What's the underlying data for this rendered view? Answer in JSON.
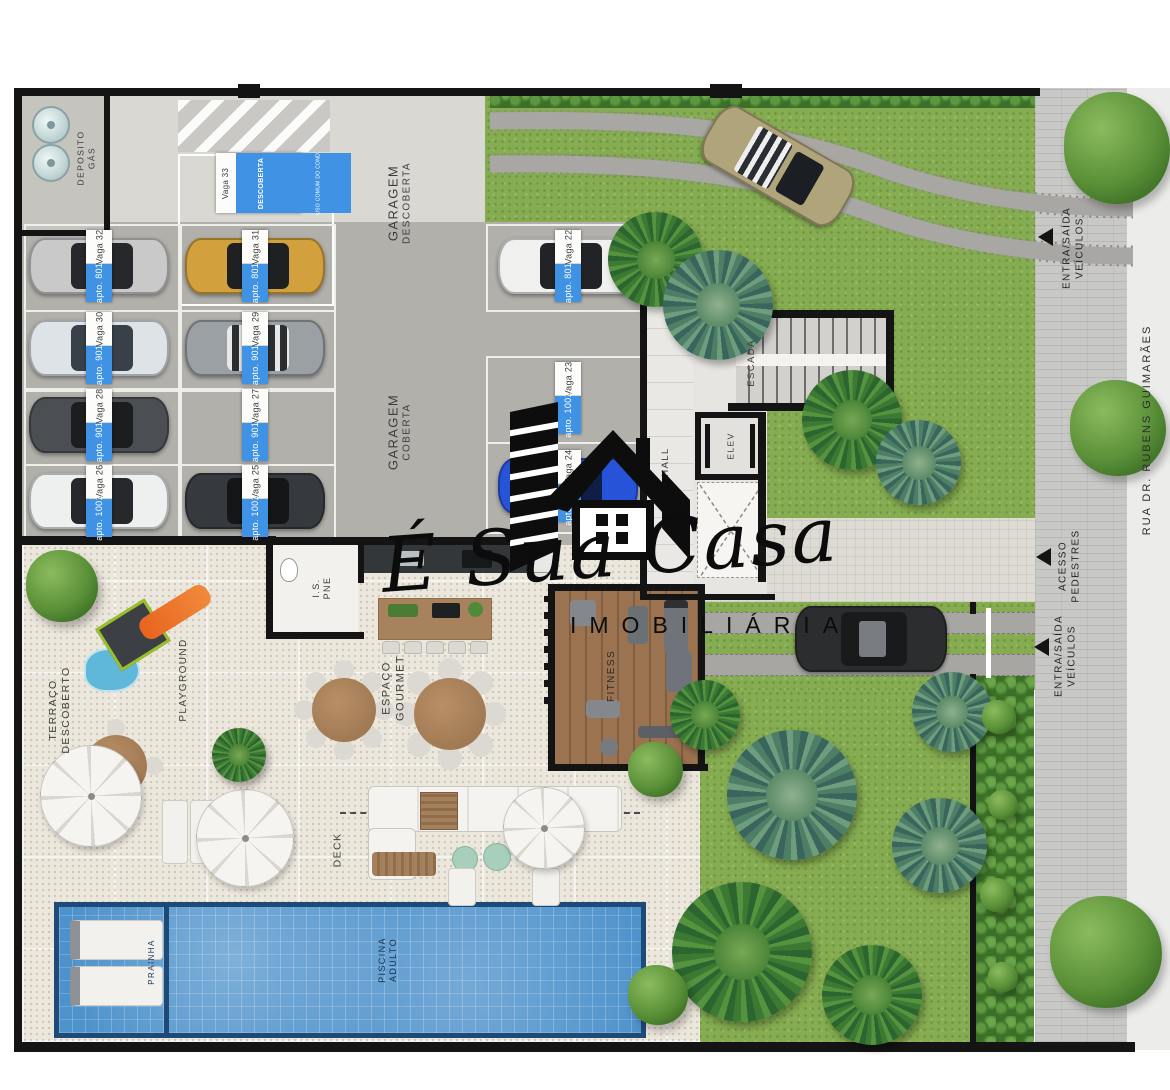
{
  "palette": {
    "tag_blue": "#3f92e4",
    "grass_green": "#85ac51",
    "pool_blue": "#4e92cb",
    "garage_covered_gray": "#b2b0ab",
    "garage_uncovered_gray": "#d9d8d3",
    "wall_black": "#141414",
    "paving_beige": "#ece7dd"
  },
  "logo": {
    "title": "É Sua Casa",
    "subtitle": "IMOBILIÁRIA"
  },
  "street": {
    "name": "RUA DR. RUBENS GUIMARÃES",
    "vehicle_entrance_top": {
      "line1": "ENTRA/SAÍDA",
      "line2": "VEÍCULOS"
    },
    "pedestrian_access": {
      "line1": "ACESSO",
      "line2": "PEDESTRES"
    },
    "vehicle_entrance_bottom": {
      "line1": "ENTRA/SAÍDA",
      "line2": "VEÍCULOS"
    }
  },
  "garage": {
    "uncovered": {
      "line1": "GARAGEM",
      "line2": "DESCOBERTA"
    },
    "covered": {
      "line1": "GARAGEM",
      "line2": "COBERTA"
    },
    "gas_room": {
      "line1": "DEPOSITO",
      "line2": "GÁS"
    }
  },
  "building": {
    "hall": "HALL",
    "stairs": "ESCADA",
    "elevator": "ELEV"
  },
  "leisure": {
    "terrace": {
      "line1": "TERRAÇO",
      "line2": "DESCOBERTO"
    },
    "playground": "PLAYGROUND",
    "gourmet": {
      "line1": "ESPAÇO",
      "line2": "GOURMET"
    },
    "fitness": "FITNESS",
    "deck": "DECK",
    "accessible_wc": {
      "line1": "I.S.",
      "line2": "PNE"
    },
    "pool_kids": "PRAINHA",
    "pool_adult": {
      "line1": "PISCINA",
      "line2": "ADULTO"
    }
  },
  "parking": {
    "spot33": {
      "vaga": "Vaga 33",
      "big": "DESCOBERTA",
      "small": "USO COMUM DO COND."
    },
    "spots": [
      {
        "vaga": "Vaga 32",
        "apto": "apto. 801"
      },
      {
        "vaga": "Vaga 31",
        "apto": "apto. 801"
      },
      {
        "vaga": "Vaga 30",
        "apto": "apto. 901"
      },
      {
        "vaga": "Vaga 29",
        "apto": "apto. 901"
      },
      {
        "vaga": "Vaga 28",
        "apto": "apto. 901"
      },
      {
        "vaga": "Vaga 27",
        "apto": "apto. 901"
      },
      {
        "vaga": "Vaga 26",
        "apto": "apto. 1001"
      },
      {
        "vaga": "Vaga 25",
        "apto": "apto. 1001"
      },
      {
        "vaga": "Vaga 22",
        "apto": "apto. 801"
      },
      {
        "vaga": "Vaga 23",
        "apto": "apto. 1001"
      },
      {
        "vaga": "Vaga 24",
        "apto": "apto. 1001"
      }
    ]
  }
}
